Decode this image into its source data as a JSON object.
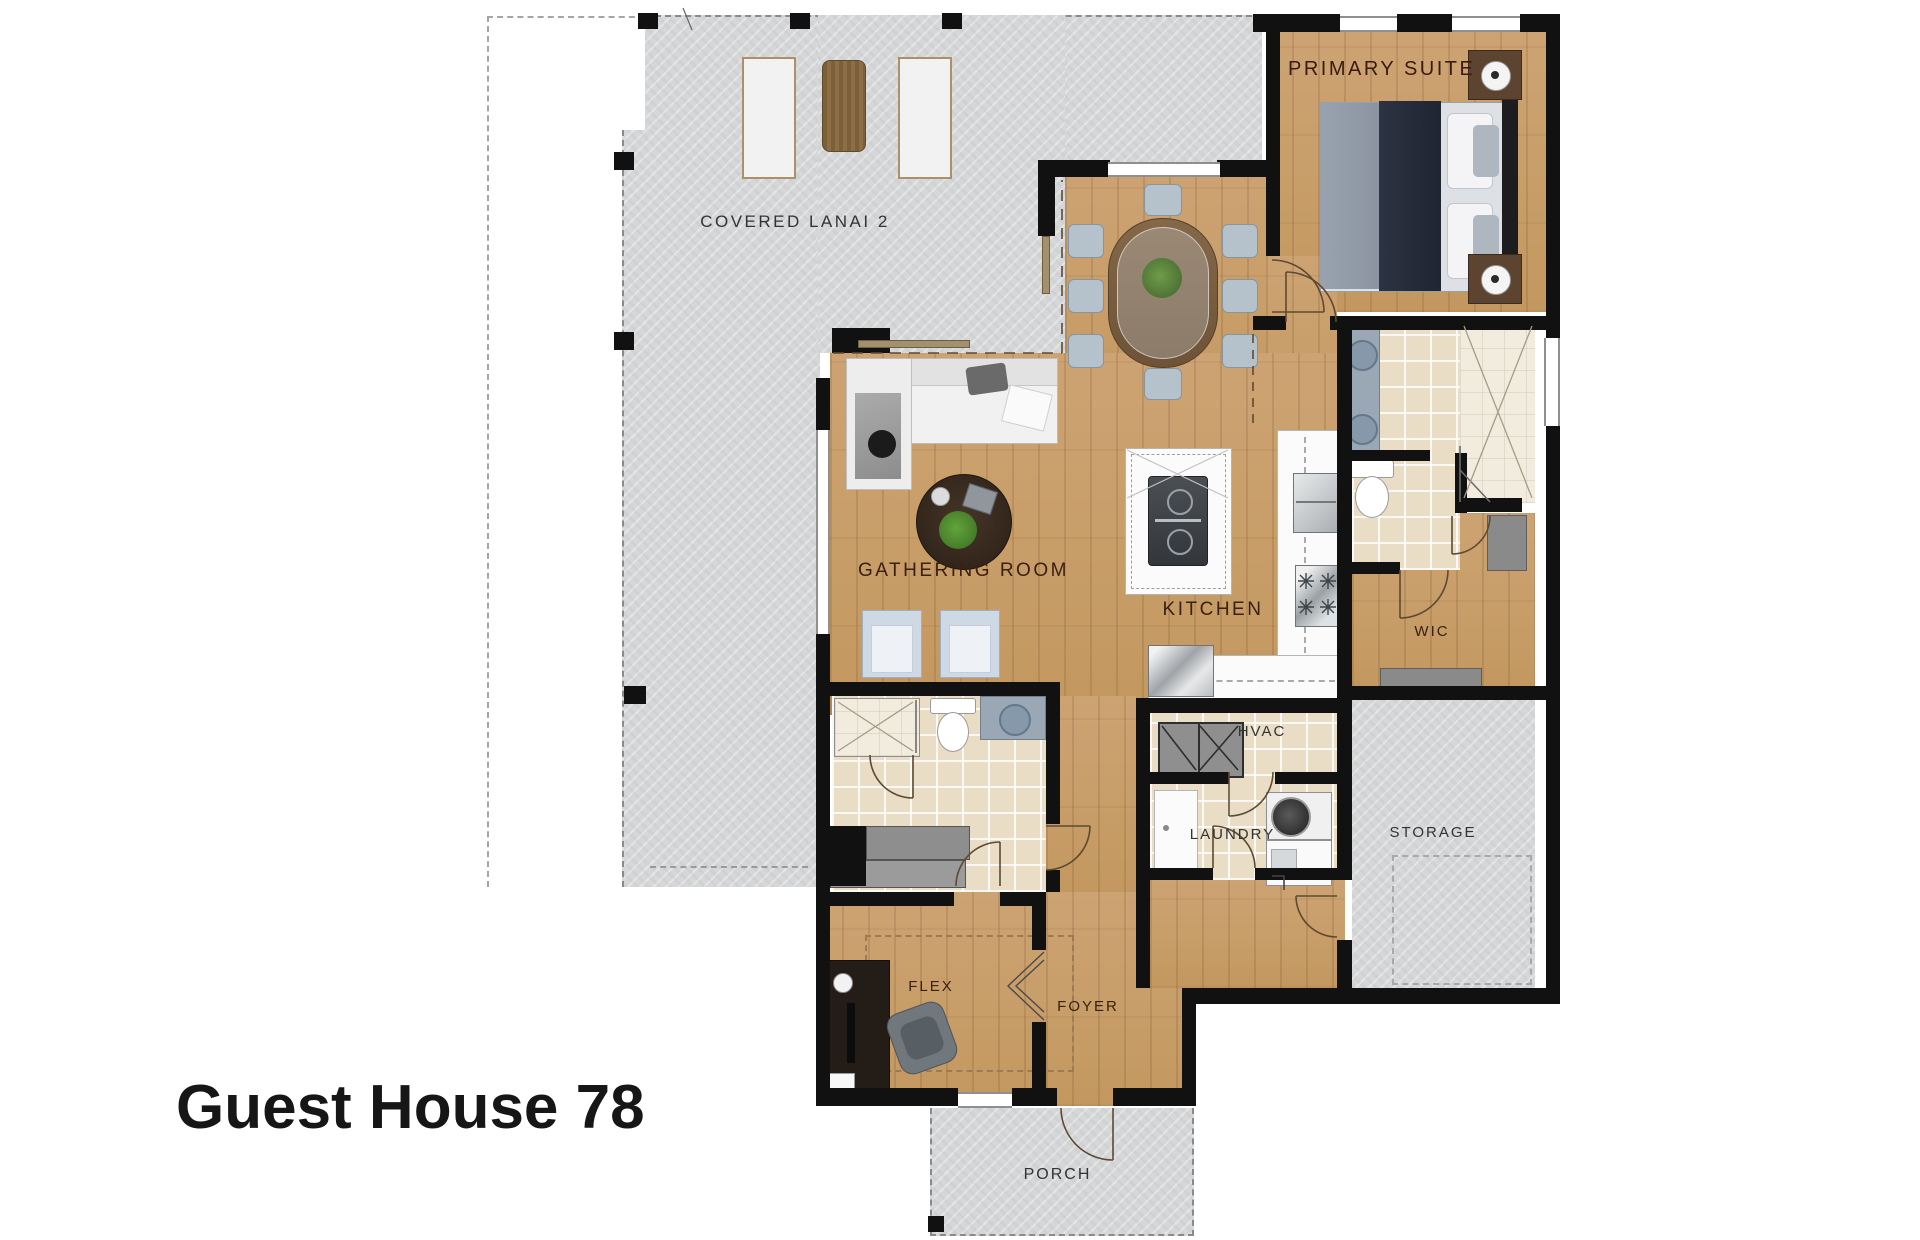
{
  "title": "Guest House 78",
  "rooms": {
    "covered_lanai": "COVERED LANAI 2",
    "primary_suite": "PRIMARY SUITE",
    "gathering_room": "GATHERING ROOM",
    "kitchen": "KITCHEN",
    "wic": "WIC",
    "hvac": "HVAC",
    "laundry": "LAUNDRY",
    "storage": "STORAGE",
    "flex": "FLEX",
    "foyer": "FOYER",
    "porch": "PORCH"
  },
  "colors": {
    "wood_floor": "#c89e6f",
    "concrete": "#d6d7d8",
    "tile": "#e9ddc6",
    "wall": "#111111",
    "room_label_brown": "#3a2013",
    "utility_label_gray": "#333333"
  }
}
